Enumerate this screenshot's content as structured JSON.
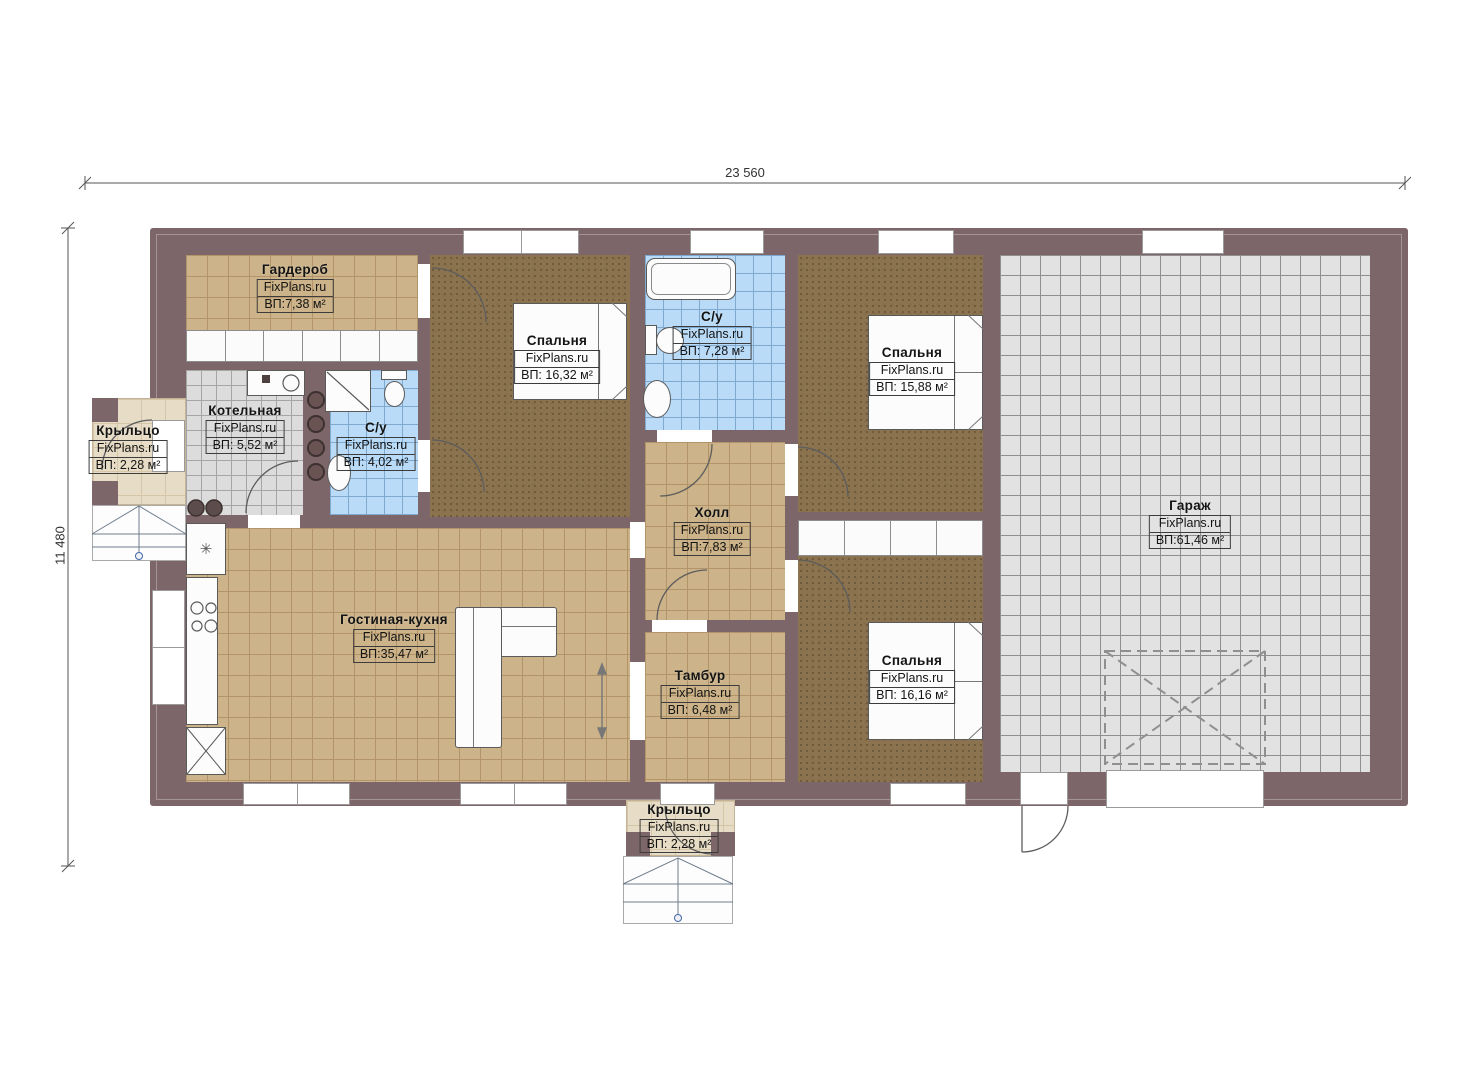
{
  "brand": "FixPlans.ru",
  "dimensions": {
    "width": "23 560",
    "height": "11 480"
  },
  "rooms": [
    {
      "id": "wardrobe",
      "name": "Гардероб",
      "area": "ВП:7,38 м²"
    },
    {
      "id": "bedroom1",
      "name": "Спальня",
      "area": "ВП: 16,32 м²"
    },
    {
      "id": "bathroom1",
      "name": "С/у",
      "area": "ВП: 7,28 м²"
    },
    {
      "id": "bedroom2",
      "name": "Спальня",
      "area": "ВП: 15,88 м²"
    },
    {
      "id": "garage",
      "name": "Гараж",
      "area": "ВП:61,46 м²"
    },
    {
      "id": "boiler",
      "name": "Котельная",
      "area": "ВП: 5,52 м²"
    },
    {
      "id": "bathroom2",
      "name": "С/у",
      "area": "ВП: 4,02 м²"
    },
    {
      "id": "porch_left",
      "name": "Крыльцо",
      "area": "ВП: 2,28 м²"
    },
    {
      "id": "hall",
      "name": "Холл",
      "area": "ВП:7,83 м²"
    },
    {
      "id": "living",
      "name": "Гостиная-кухня",
      "area": "ВП:35,47 м²"
    },
    {
      "id": "vestibule",
      "name": "Тамбур",
      "area": "ВП: 6,48 м²"
    },
    {
      "id": "bedroom3",
      "name": "Спальня",
      "area": "ВП: 16,16 м²"
    },
    {
      "id": "porch_bottom",
      "name": "Крыльцо",
      "area": "ВП: 2,28 м²"
    }
  ],
  "icons": {
    "fridge_symbol": "✳"
  },
  "colors": {
    "wall": "#7c6669",
    "floor_tan": "#ccb389",
    "floor_blue": "#badbf7",
    "floor_grey": "#dcdcdc",
    "carpet_brown": "#8a734e",
    "porch_beige": "#e7dcc6"
  }
}
